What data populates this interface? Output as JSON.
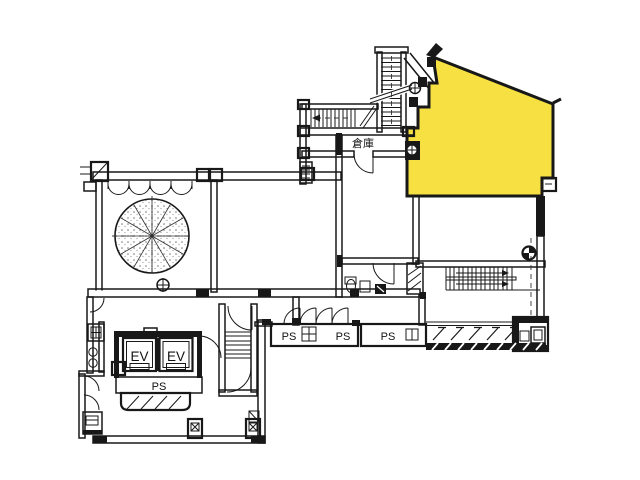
{
  "document": {
    "type": "architectural-floor-plan",
    "style": "scanned monochrome line drawing with one unit highlighted"
  },
  "colors": {
    "highlight": "#F6E042",
    "line": "#181818",
    "background": "#FFFFFF"
  },
  "labels": {
    "storage": "倉庫",
    "elevator_1": "EV",
    "elevator_2": "EV",
    "ps_core": "PS",
    "ps_shaft_1": "PS",
    "ps_shaft_2": "PS",
    "ps_shaft_3": "PS"
  }
}
